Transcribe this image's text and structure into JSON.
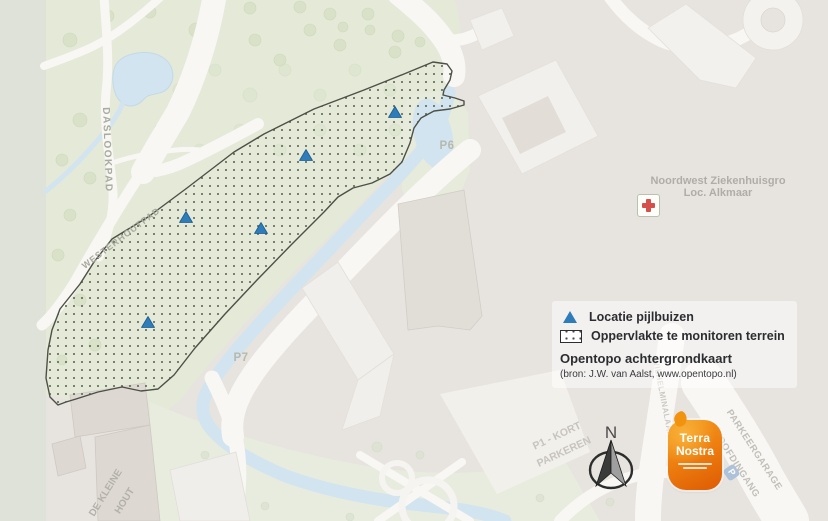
{
  "map": {
    "labels": {
      "daslookpad": "DASLOOKPAD",
      "westerhoutpad": "WESTERHOUTPAD",
      "p6": "P6",
      "p7": "P7",
      "hospital_line1": "Noordwest Ziekenhuisgro",
      "hospital_line2": "Loc. Alkmaar",
      "p1_kort_line1": "P1 - KORT",
      "p1_kort_line2": "PARKEREN",
      "de_kleine_hout_line1": "DE KLEINE",
      "de_kleine_hout_line2": "HOUT",
      "wilhelminalaan": "WILHELMINALAAN",
      "parkeergarage": "PARKEERGARAGE",
      "hoofdingang": "HOOFDINGANG",
      "parking_icon_letter": "P"
    }
  },
  "legend": {
    "items": [
      {
        "symbol": "triangle-marker",
        "label": "Locatie pijlbuizen"
      },
      {
        "symbol": "dotted-area",
        "label": "Oppervlakte te monitoren terrein"
      }
    ],
    "source_title": "Opentopo achtergrondkaart",
    "source_note": "(bron: J.W. van Aalst, www.opentopo.nl)"
  },
  "north_arrow": {
    "label": "N"
  },
  "logo": {
    "line1": "Terra",
    "line2": "Nostra"
  },
  "colors": {
    "marker_blue": "#2e7cb9",
    "polygon_dot": "#5a6350",
    "polygon_border": "#4d5046",
    "park_green": "#e4e9d8",
    "water_blue": "#d2e4ef",
    "campus_gray": "#e7e3df",
    "road_white": "#f8f7f3",
    "map_label_gray": "#b3b0aa",
    "legend_text": "#2c2d31",
    "logo_orange": "#ed7e0f",
    "hospital_cross_red": "#d5504c"
  }
}
